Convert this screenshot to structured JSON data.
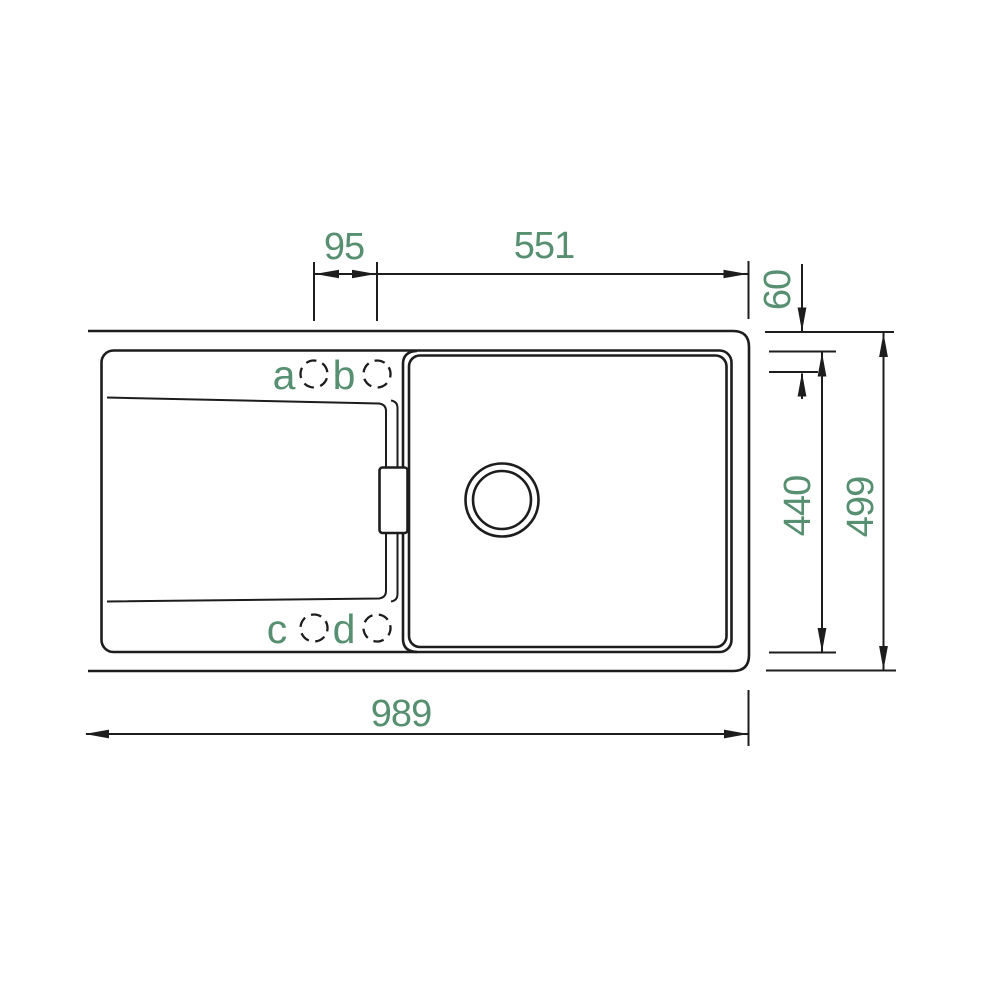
{
  "drawing": {
    "title": "sink-top-view-technical-drawing",
    "accent_color": "#579070",
    "line_color": "#1d1d1d",
    "dimensions": {
      "hole_spacing": "95",
      "hole_to_right_edge": "551",
      "edge_to_hole_center": "60",
      "inner_depth": "440",
      "overall_depth": "499",
      "overall_width": "989"
    },
    "tap_holes": {
      "a": "a",
      "b": "b",
      "c": "c",
      "d": "d"
    }
  }
}
